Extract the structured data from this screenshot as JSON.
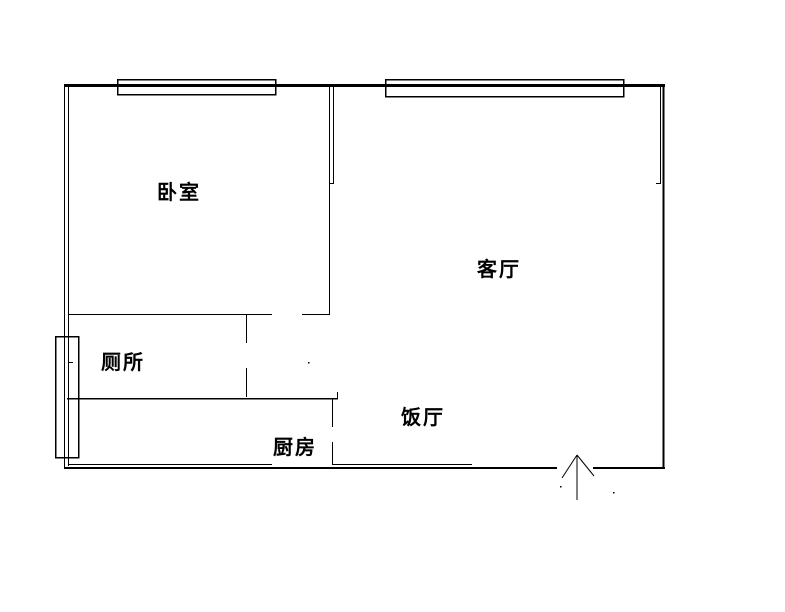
{
  "document": {
    "type": "apartment-floor-plan"
  },
  "colors": {
    "line": "#000000",
    "background": "#ffffff"
  },
  "rooms": {
    "bedroom": {
      "label": "卧室"
    },
    "living_room": {
      "label": "客厅"
    },
    "toilet": {
      "label": "厕所"
    },
    "dining_room": {
      "label": "饭厅"
    },
    "kitchen": {
      "label": "厨房"
    }
  },
  "plan": {
    "canvas": {
      "width": 785,
      "height": 612
    },
    "walls": [
      {
        "name": "top-wall",
        "x1": 64,
        "y1": 85.5,
        "x2": 665,
        "y2": 85.5,
        "w": 3
      },
      {
        "name": "left-wall-outer",
        "x1": 64.5,
        "y1": 84,
        "x2": 64.5,
        "y2": 469,
        "w": 1
      },
      {
        "name": "left-wall-inner",
        "x1": 68.5,
        "y1": 84,
        "x2": 68.5,
        "y2": 466,
        "w": 1
      },
      {
        "name": "left-wall-inner-tick",
        "x1": 68,
        "y1": 362.5,
        "x2": 73,
        "y2": 362.5,
        "w": 1
      },
      {
        "name": "right-wall-outer",
        "x1": 663.5,
        "y1": 84,
        "x2": 663.5,
        "y2": 469,
        "w": 2
      },
      {
        "name": "right-wall-inner",
        "x1": 660.5,
        "y1": 87,
        "x2": 660.5,
        "y2": 183,
        "w": 1
      },
      {
        "name": "right-wall-inner-end-tick",
        "x1": 656,
        "y1": 183.5,
        "x2": 661,
        "y2": 183.5,
        "w": 1
      },
      {
        "name": "bottom-wall-left",
        "x1": 64,
        "y1": 468,
        "x2": 557,
        "y2": 468,
        "w": 2
      },
      {
        "name": "bottom-wall-right",
        "x1": 593,
        "y1": 468,
        "x2": 665,
        "y2": 468,
        "w": 2
      },
      {
        "name": "bedroom-living-wall-outer",
        "x1": 329.5,
        "y1": 85,
        "x2": 329.5,
        "y2": 314,
        "w": 1
      },
      {
        "name": "bedroom-living-wall-inner",
        "x1": 333.5,
        "y1": 85,
        "x2": 333.5,
        "y2": 183,
        "w": 1
      },
      {
        "name": "bedroom-living-wall-end-tick",
        "x1": 329,
        "y1": 183.5,
        "x2": 334,
        "y2": 183.5,
        "w": 1
      },
      {
        "name": "bedroom-south-wall-west",
        "x1": 68,
        "y1": 314.5,
        "x2": 272,
        "y2": 314.5,
        "w": 1
      },
      {
        "name": "bedroom-south-wall-east",
        "x1": 302,
        "y1": 314.5,
        "x2": 330,
        "y2": 314.5,
        "w": 1
      },
      {
        "name": "toilet-partition-upper",
        "x1": 246.5,
        "y1": 314,
        "x2": 246.5,
        "y2": 343,
        "w": 1
      },
      {
        "name": "toilet-partition-lower",
        "x1": 246.5,
        "y1": 368,
        "x2": 246.5,
        "y2": 397,
        "w": 1
      },
      {
        "name": "toilet-south-wall",
        "x1": 67,
        "y1": 398.5,
        "x2": 338,
        "y2": 398.5,
        "w": 1.5
      },
      {
        "name": "toilet-south-wall-end-tick",
        "x1": 337.5,
        "y1": 392,
        "x2": 337.5,
        "y2": 398,
        "w": 1
      },
      {
        "name": "kitchen-partition-upper",
        "x1": 332.5,
        "y1": 398,
        "x2": 332.5,
        "y2": 427,
        "w": 1
      },
      {
        "name": "kitchen-partition-lower",
        "x1": 332.5,
        "y1": 442,
        "x2": 332.5,
        "y2": 464,
        "w": 1
      },
      {
        "name": "inner-bottom-line-west",
        "x1": 68,
        "y1": 464.5,
        "x2": 272,
        "y2": 464.5,
        "w": 1
      },
      {
        "name": "inner-bottom-line-east",
        "x1": 332,
        "y1": 464.5,
        "x2": 472,
        "y2": 464.5,
        "w": 1
      }
    ],
    "windows": [
      {
        "name": "bedroom-window",
        "x": 117,
        "y": 79,
        "width": 158,
        "height": 15
      },
      {
        "name": "living-room-window",
        "x": 385,
        "y": 79,
        "width": 238,
        "height": 17
      },
      {
        "name": "toilet-window",
        "x": 55,
        "y": 336,
        "width": 23,
        "height": 121
      }
    ],
    "entrance_arrow": {
      "name": "entrance-arrow",
      "shaft": {
        "x1": 577,
        "y1": 455,
        "x2": 577,
        "y2": 500
      },
      "left_wing": {
        "x1": 577,
        "y1": 455,
        "x2": 562,
        "y2": 478
      },
      "right_wing": {
        "x1": 577,
        "y1": 455,
        "x2": 594,
        "y2": 476
      }
    },
    "specks": [
      {
        "x": 560,
        "y": 486
      },
      {
        "x": 613,
        "y": 492
      },
      {
        "x": 308,
        "y": 362
      }
    ]
  }
}
